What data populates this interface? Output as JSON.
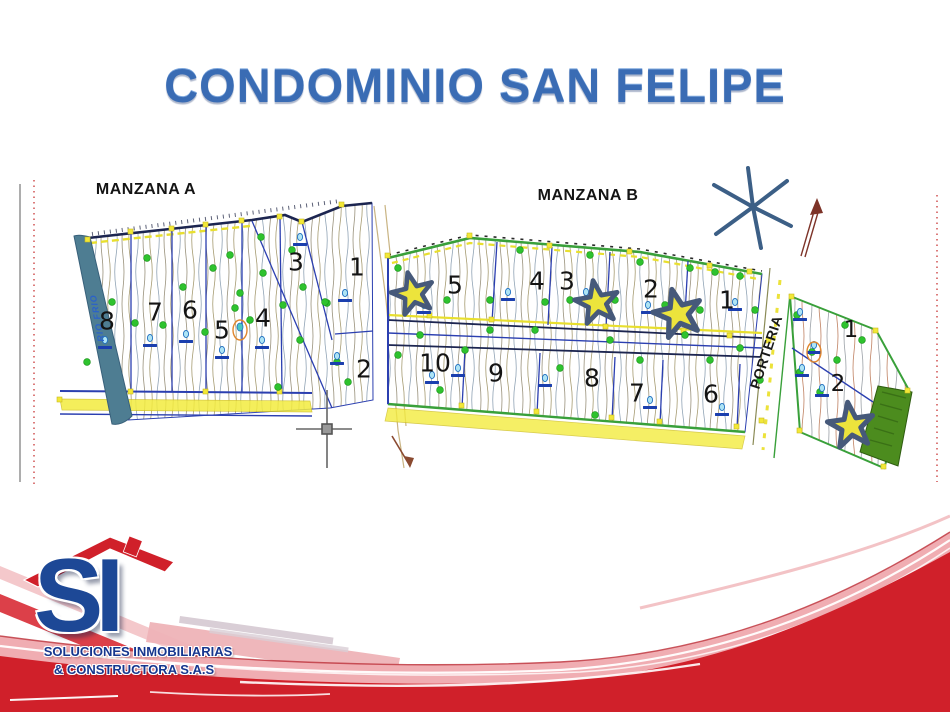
{
  "title": "CONDOMINIO SAN FELIPE",
  "map": {
    "manzana_a": {
      "label": "MANZANA A",
      "lots": [
        "8",
        "7",
        "6",
        "5",
        "4",
        "3",
        "1",
        "2"
      ]
    },
    "manzana_b": {
      "label": "MANZANA B",
      "lots_top": [
        "5",
        "4",
        "3",
        "2",
        "1"
      ],
      "lots_bottom": [
        "10",
        "9",
        "8",
        "7",
        "6"
      ]
    },
    "annex": {
      "lots": [
        "1",
        "2"
      ]
    },
    "porteria_label": "PORTERIA",
    "river_label": "RIO FRIO"
  },
  "logo": {
    "monogram": "SI",
    "line1": "SOLUCIONES INMOBILIARIAS",
    "line2": "& CONSTRUCTORA S.A.S"
  },
  "colors": {
    "title_blue": "#3a6cb4",
    "brand_red": "#d0202a",
    "logo_blue": "#1d4896",
    "star_yellow": "#ece43c",
    "star_outline": "#46597a",
    "tree_green": "#2ec22e",
    "survey_yellow": "#f2e838",
    "parcel_blue": "#2b3fb0",
    "river_teal": "#4e7d92",
    "green_zone": "#4c8c1e"
  }
}
